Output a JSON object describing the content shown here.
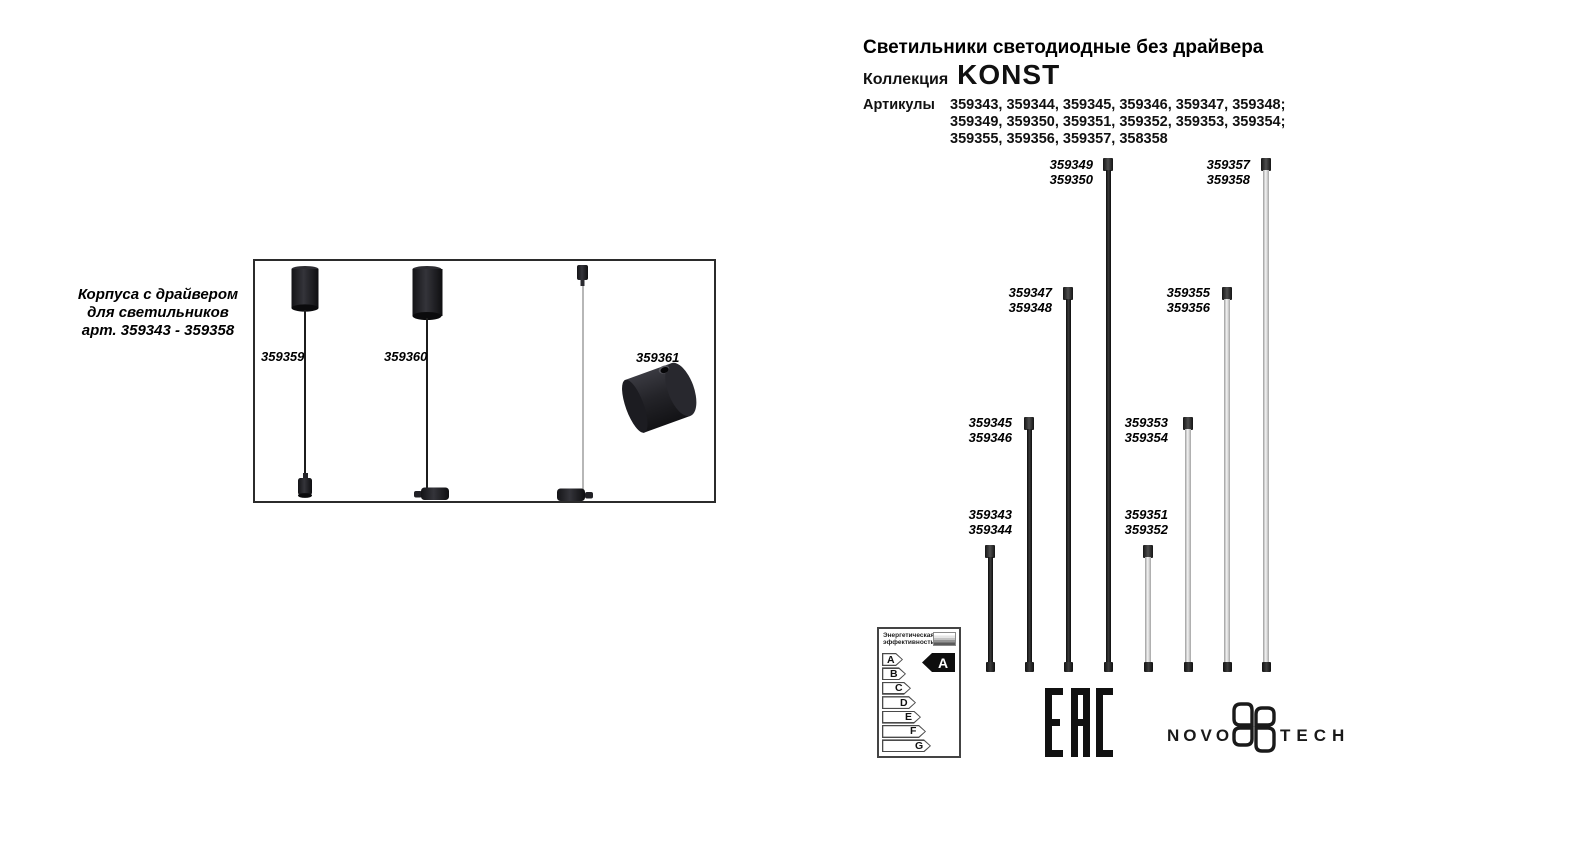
{
  "header": {
    "title": "Светильники светодиодные без драйвера",
    "collection_label": "Коллекция",
    "collection_name": "KONST",
    "articles_label": "Артикулы",
    "articles_lines": [
      "359343, 359344, 359345, 359346, 359347, 359348;",
      "359349, 359350, 359351, 359352, 359353, 359354;",
      "359355, 359356, 359357, 358358"
    ]
  },
  "left_panel": {
    "caption_lines": [
      "Корпуса с драйвером",
      "для светильников",
      "арт. 359343 - 359358"
    ],
    "products": [
      {
        "article": "359359",
        "type": "pendant-canopy-with-driver"
      },
      {
        "article": "359360",
        "type": "pendant-canopy-with-driver"
      },
      {
        "article": "359361",
        "type": "surface-drum-with-driver"
      }
    ]
  },
  "tubes": [
    {
      "articles": [
        "359343",
        "359344"
      ],
      "finish": "black"
    },
    {
      "articles": [
        "359345",
        "359346"
      ],
      "finish": "black"
    },
    {
      "articles": [
        "359347",
        "359348"
      ],
      "finish": "black"
    },
    {
      "articles": [
        "359349",
        "359350"
      ],
      "finish": "black"
    },
    {
      "articles": [
        "359351",
        "359352"
      ],
      "finish": "white"
    },
    {
      "articles": [
        "359353",
        "359354"
      ],
      "finish": "white"
    },
    {
      "articles": [
        "359355",
        "359356"
      ],
      "finish": "white"
    },
    {
      "articles": [
        "359357",
        "359358"
      ],
      "finish": "white"
    }
  ],
  "energy_label": {
    "title_lines": [
      "Энергетическая",
      "эффективность"
    ],
    "classes": [
      "A",
      "B",
      "C",
      "D",
      "E",
      "F",
      "G"
    ],
    "rating": "A"
  },
  "logos": {
    "eac": "ЕАС",
    "brand_left": "NOVO",
    "brand_right": "TECH"
  },
  "colors": {
    "text": "#000000",
    "tube_black": "#1a1a1a",
    "tube_white": "#e8e8e8",
    "fixture_body": "#26262b"
  }
}
